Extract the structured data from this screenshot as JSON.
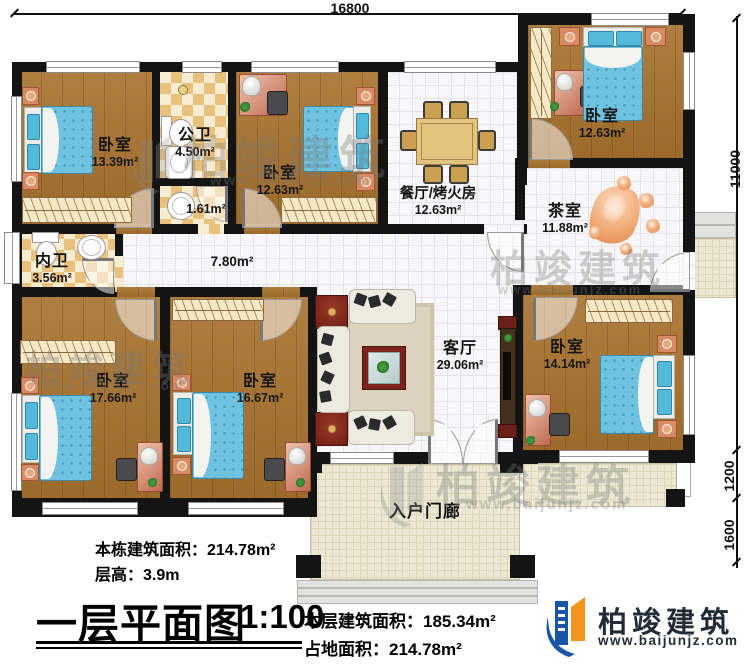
{
  "dimensions": {
    "top_width": "16800",
    "right_height": "11000",
    "right_upper": "1200",
    "right_lower": "1600"
  },
  "rooms": {
    "bedroom_tl": {
      "name": "卧室",
      "area": "13.39m²"
    },
    "bath_public": {
      "name": "公卫",
      "area": "4.50m²"
    },
    "bath_small": {
      "area": "1.61m²"
    },
    "bedroom_tm": {
      "name": "卧室",
      "area": "12.63m²"
    },
    "dining": {
      "name": "餐厅/烤火房",
      "area": "12.63m²"
    },
    "bedroom_tr": {
      "name": "卧室",
      "area": "12.63m²"
    },
    "tea": {
      "name": "茶室",
      "area": "11.88m²"
    },
    "bath_inner": {
      "name": "内卫",
      "area": "3.56m²"
    },
    "corridor": {
      "area": "7.80m²"
    },
    "bedroom_bl": {
      "name": "卧室",
      "area": "17.66m²"
    },
    "bedroom_bm": {
      "name": "卧室",
      "area": "16.67m²"
    },
    "living": {
      "name": "客厅",
      "area": "29.06m²"
    },
    "bedroom_br": {
      "name": "卧室",
      "area": "14.14m²"
    },
    "porch": {
      "name": "入户门廊"
    }
  },
  "footer": {
    "building_area": "本栋建筑面积：214.78m²",
    "floor_height": "层高：3.9m",
    "title": "一层平面图",
    "scale": "1:100",
    "level_area": "本层建筑面积：185.34m²",
    "ground_area": "占地面积：214.78m²"
  },
  "logo": {
    "name": "柏竣建筑",
    "url": "www.baijunjz.com"
  },
  "watermark": {
    "name": "柏竣建筑",
    "url": "www.baijunjz.com"
  },
  "colors": {
    "wall": "#141414",
    "wood_floor": "#a9732f",
    "bed_blue": "#6fc3e0",
    "logo_blue": "#1a56a8",
    "logo_orange": "#f2941e"
  }
}
